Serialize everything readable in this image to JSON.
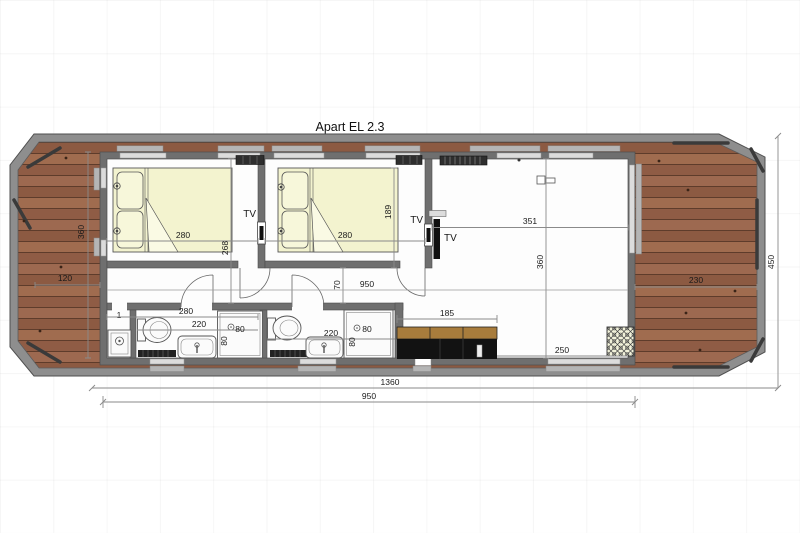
{
  "title": "Apart EL 2.3",
  "labels": {
    "tv": "TV",
    "closet_number": "1"
  },
  "dimensions": {
    "hull_length": "1360",
    "hull_width": "450",
    "cabin_length": "950",
    "interior_length": "950",
    "bow_deck_width": "120",
    "bow_deck_length": "360",
    "stern_deck_width": "230",
    "bedroom1_width": "280",
    "bedroom1_depth": "268",
    "bedroom2_width": "280",
    "bed2_length": "189",
    "living_width": "351",
    "living_depth": "360",
    "hall_passage": "70",
    "entrance_zone_width": "280",
    "bathroom1_width": "220",
    "bathroom2_width": "220",
    "shower_size": "80",
    "kitchen_length": "185",
    "kitchen_to_wall": "250"
  },
  "colors": {
    "deck_wood": "#96614a",
    "hull_gray": "#8e8e8e",
    "wall_gray": "#6f6f6f",
    "bed_fill": "#f3f3cf",
    "kitchen_top": "#a87c3c",
    "kitchen_body": "#121212",
    "dimension_line": "#8a8a8a",
    "text": "#1a1a1a"
  }
}
